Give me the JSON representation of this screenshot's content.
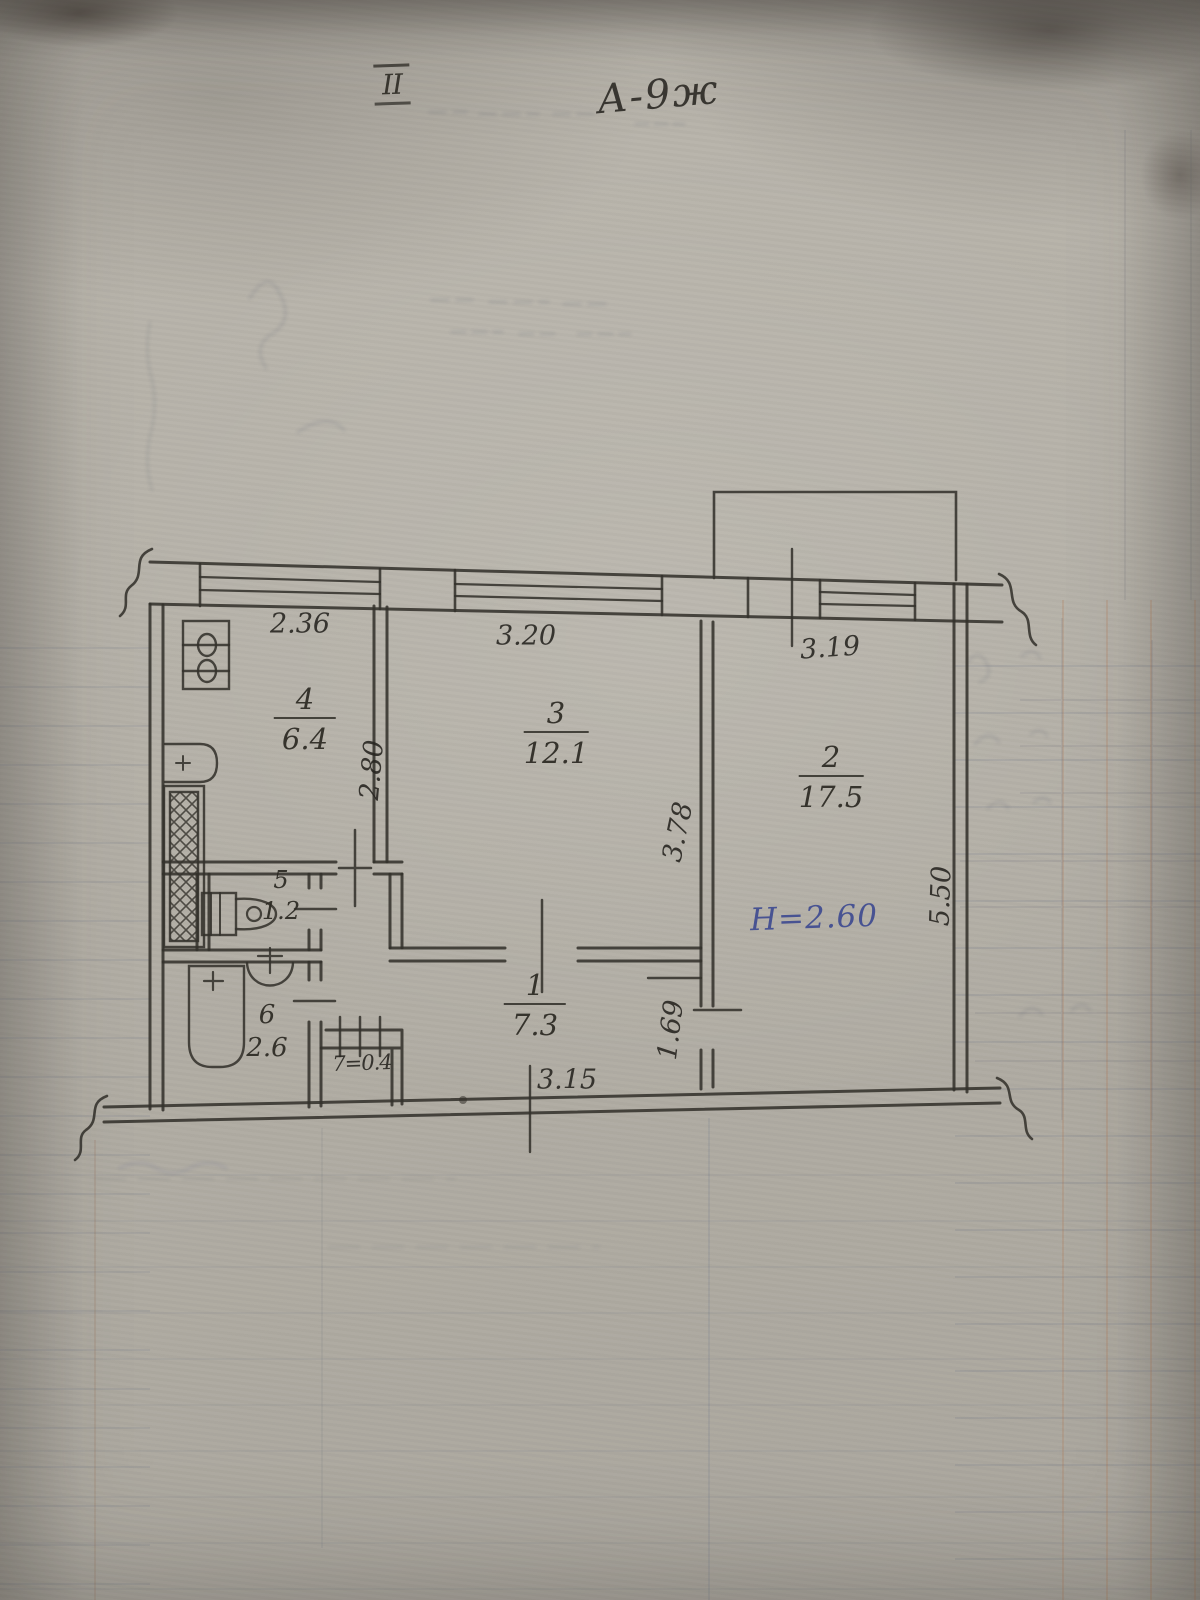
{
  "page": {
    "floor_mark": "II",
    "plan_code": "А-9ж"
  },
  "annotations": {
    "ceiling_height": "Н=2.60"
  },
  "rooms": {
    "r1": {
      "number": "1",
      "area": "7.3"
    },
    "r2": {
      "number": "2",
      "area": "17.5"
    },
    "r3": {
      "number": "3",
      "area": "12.1"
    },
    "r4": {
      "number": "4",
      "area": "6.4"
    },
    "r5": {
      "number": "5",
      "area": "1.2"
    },
    "r6": {
      "number": "6",
      "area": "2.6"
    },
    "r7": {
      "label": "7=0.4"
    }
  },
  "dimensions": {
    "top_left": "2.36",
    "top_middle": "3.20",
    "top_right": "3.19",
    "kitchen_depth": "2.80",
    "room3_depth": "3.78",
    "room2_depth": "5.50",
    "hall_depth": "1.69",
    "hall_width": "3.15"
  },
  "fixtures": [
    "stove",
    "sink",
    "toilet",
    "washbasin",
    "bathtub",
    "ventilation-shaft"
  ],
  "colors": {
    "ink": "#34322c",
    "blue_ink": "#3a478f",
    "paper": "#b4b0a7"
  }
}
